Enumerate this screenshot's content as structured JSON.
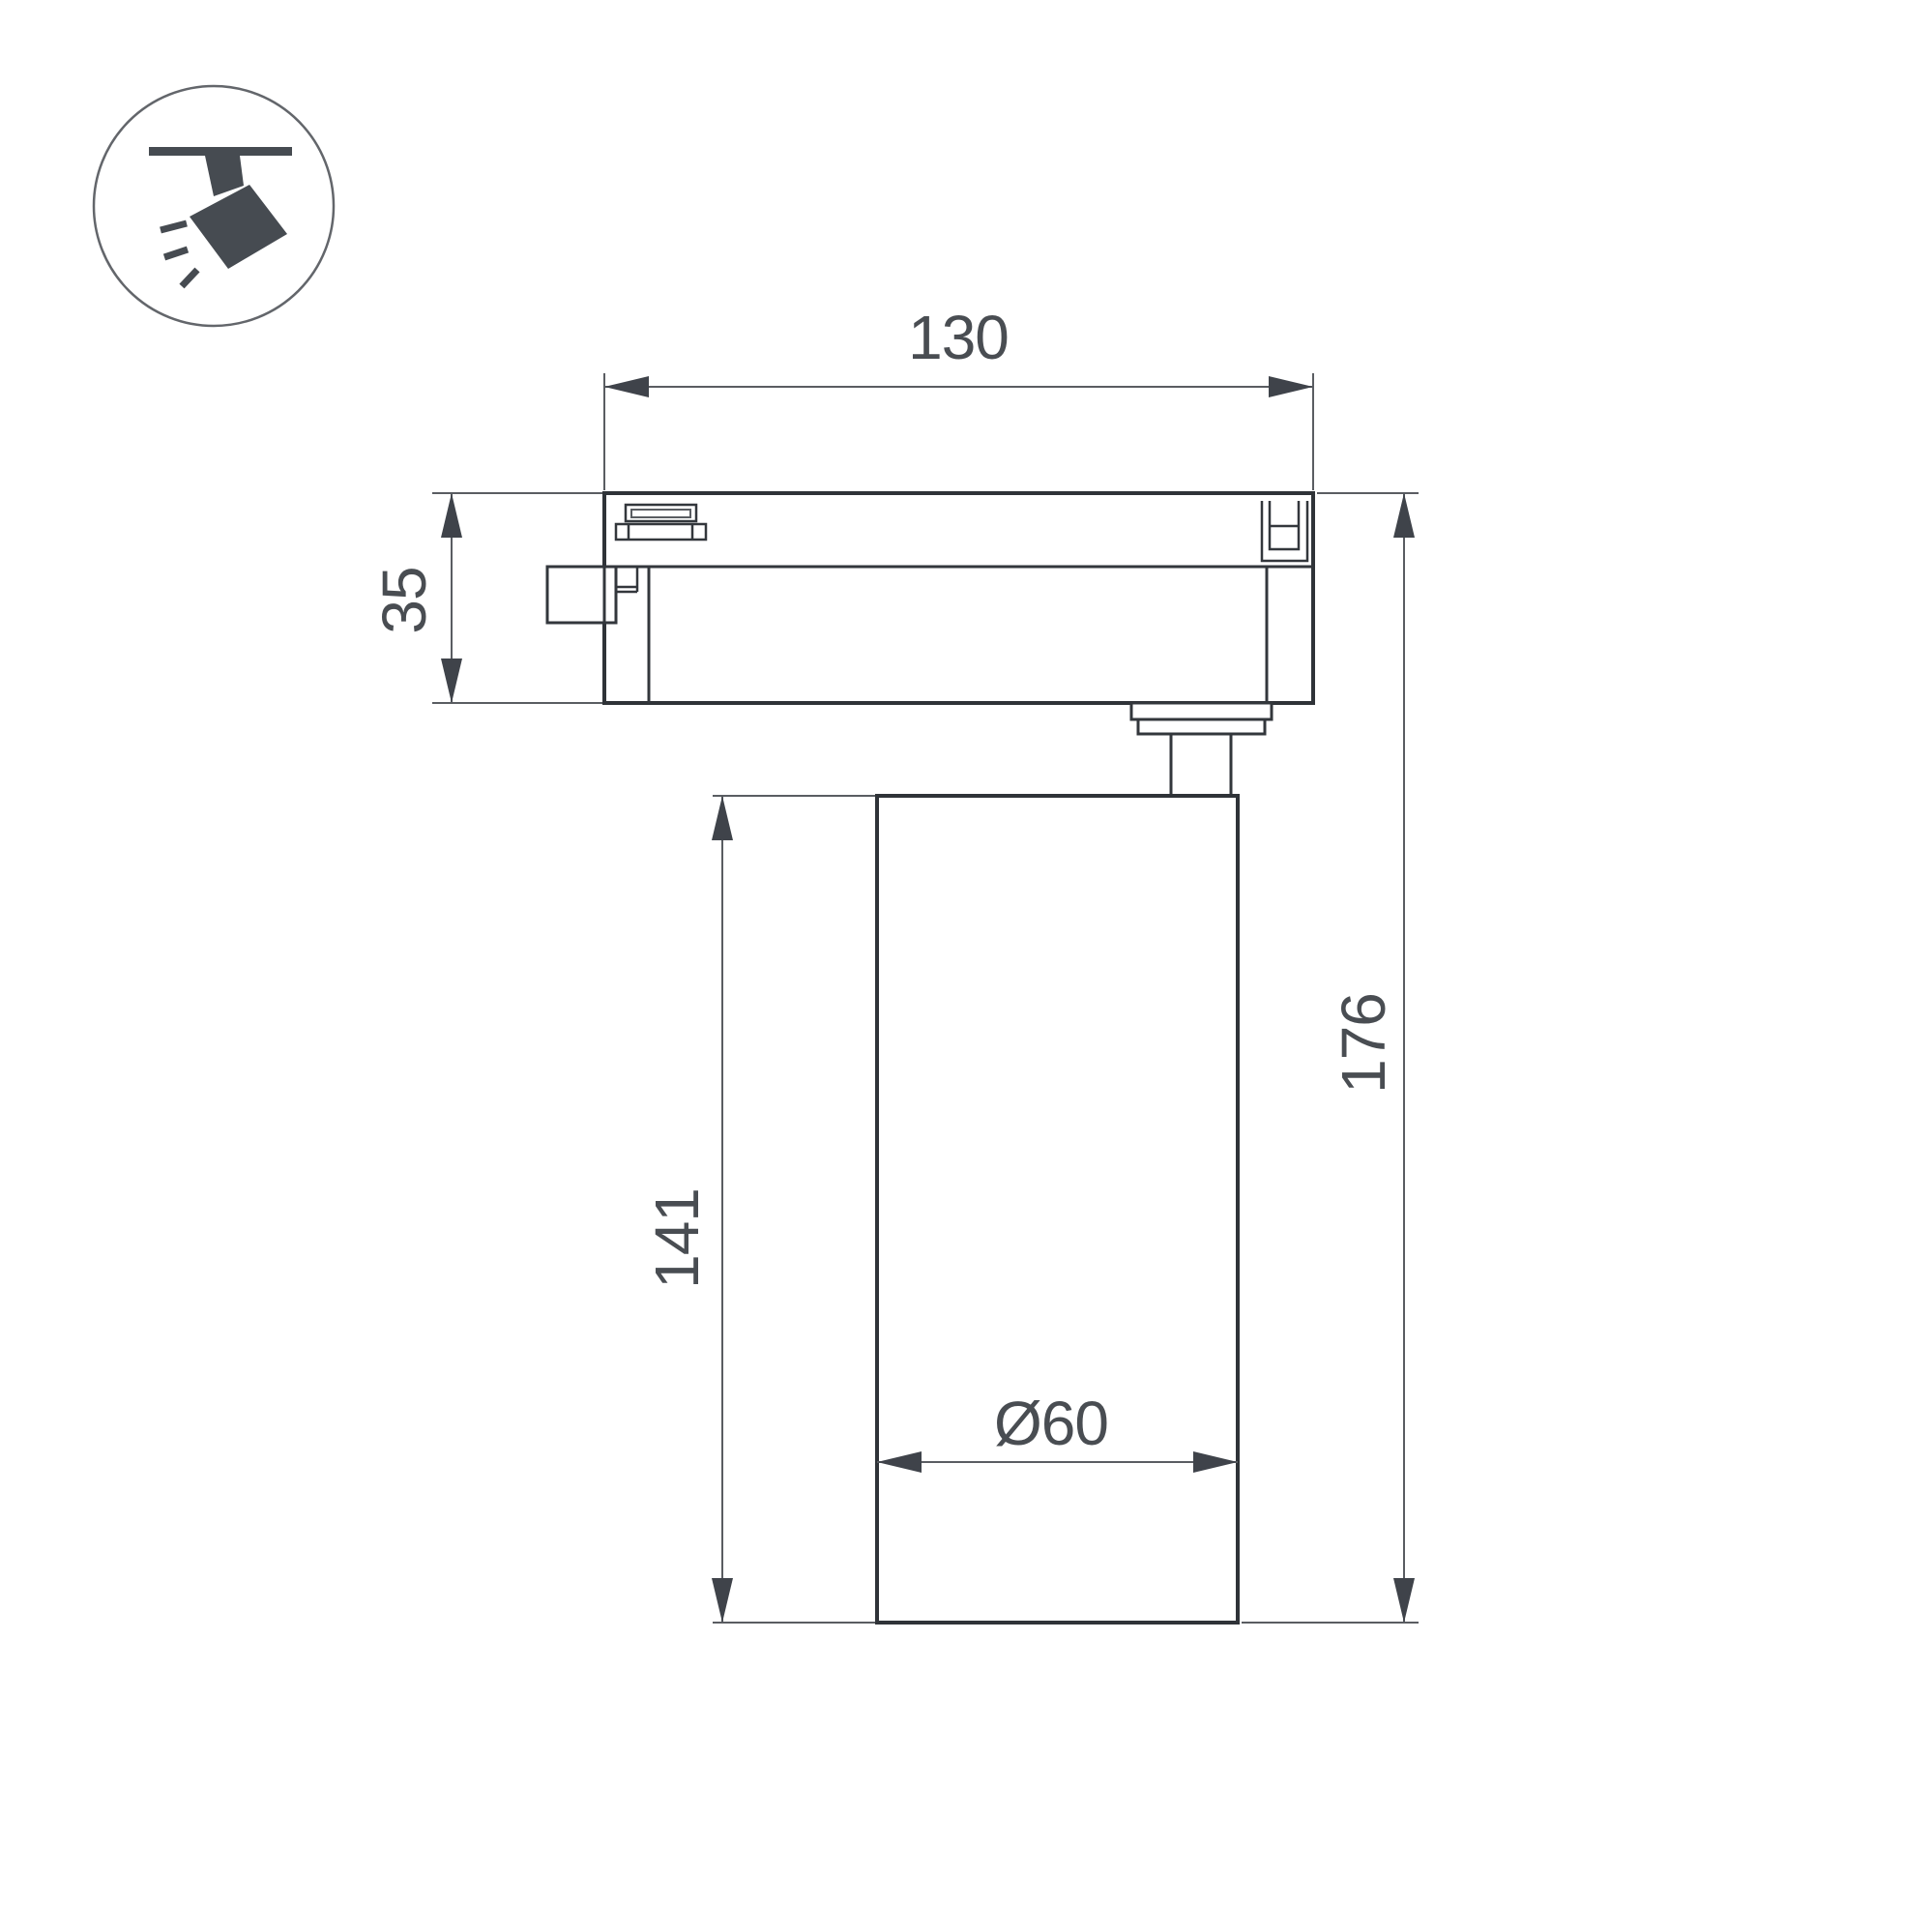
{
  "drawing": {
    "type": "technical-dimension-drawing",
    "subject": "track-mounted spotlight, side view"
  },
  "icons": {
    "corner_badge": "track-spotlight-icon"
  },
  "dimensions": {
    "adapter_length": "130",
    "adapter_height": "35",
    "body_length": "141",
    "overall_height": "176",
    "body_diameter": "Ø60"
  },
  "colors": {
    "background": "#ffffff",
    "part_line": "#2f3338",
    "dimension_line": "#5a5d62",
    "arrow": "#3f434a",
    "text": "#494d52",
    "icon": "#464b51"
  }
}
